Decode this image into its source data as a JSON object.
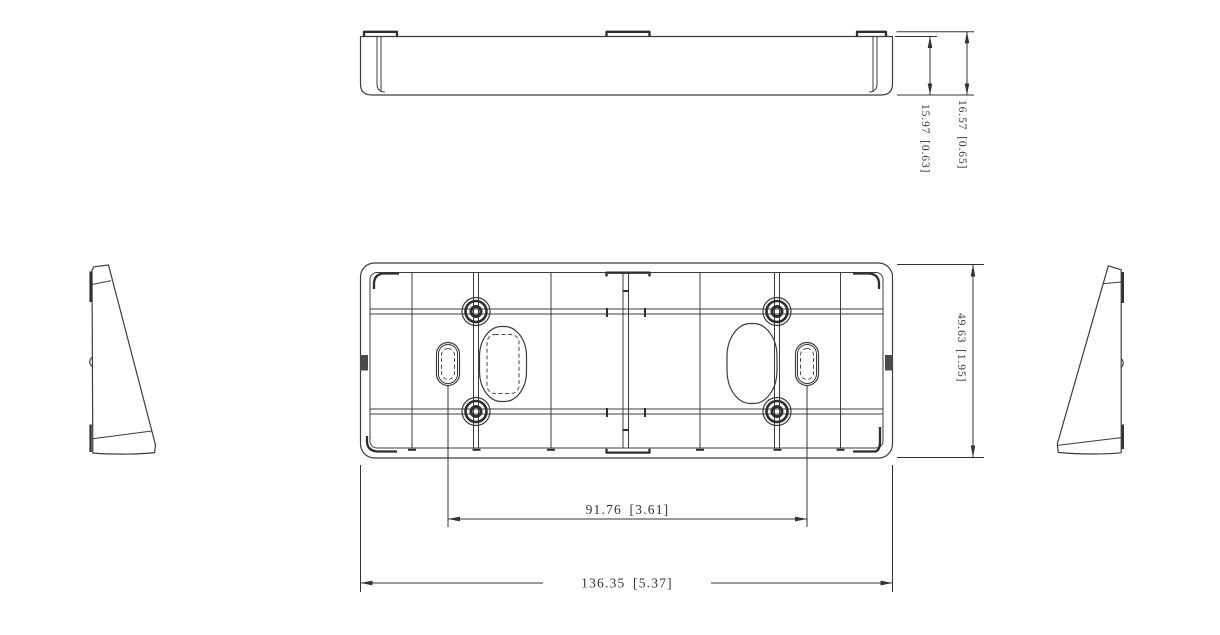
{
  "colors": {
    "background": "#ffffff",
    "line": "#3c3c3c",
    "dimension_line": "#333333",
    "text": "#333333"
  },
  "dimensions": {
    "profile_inner_height": "15.97 [0.63]",
    "profile_overall_height": "16.57 [0.65]",
    "slot_spacing": "91.76 [3.61]",
    "overall_width": "136.35 [5.37]",
    "overall_height": "49.63 [1.95]"
  }
}
